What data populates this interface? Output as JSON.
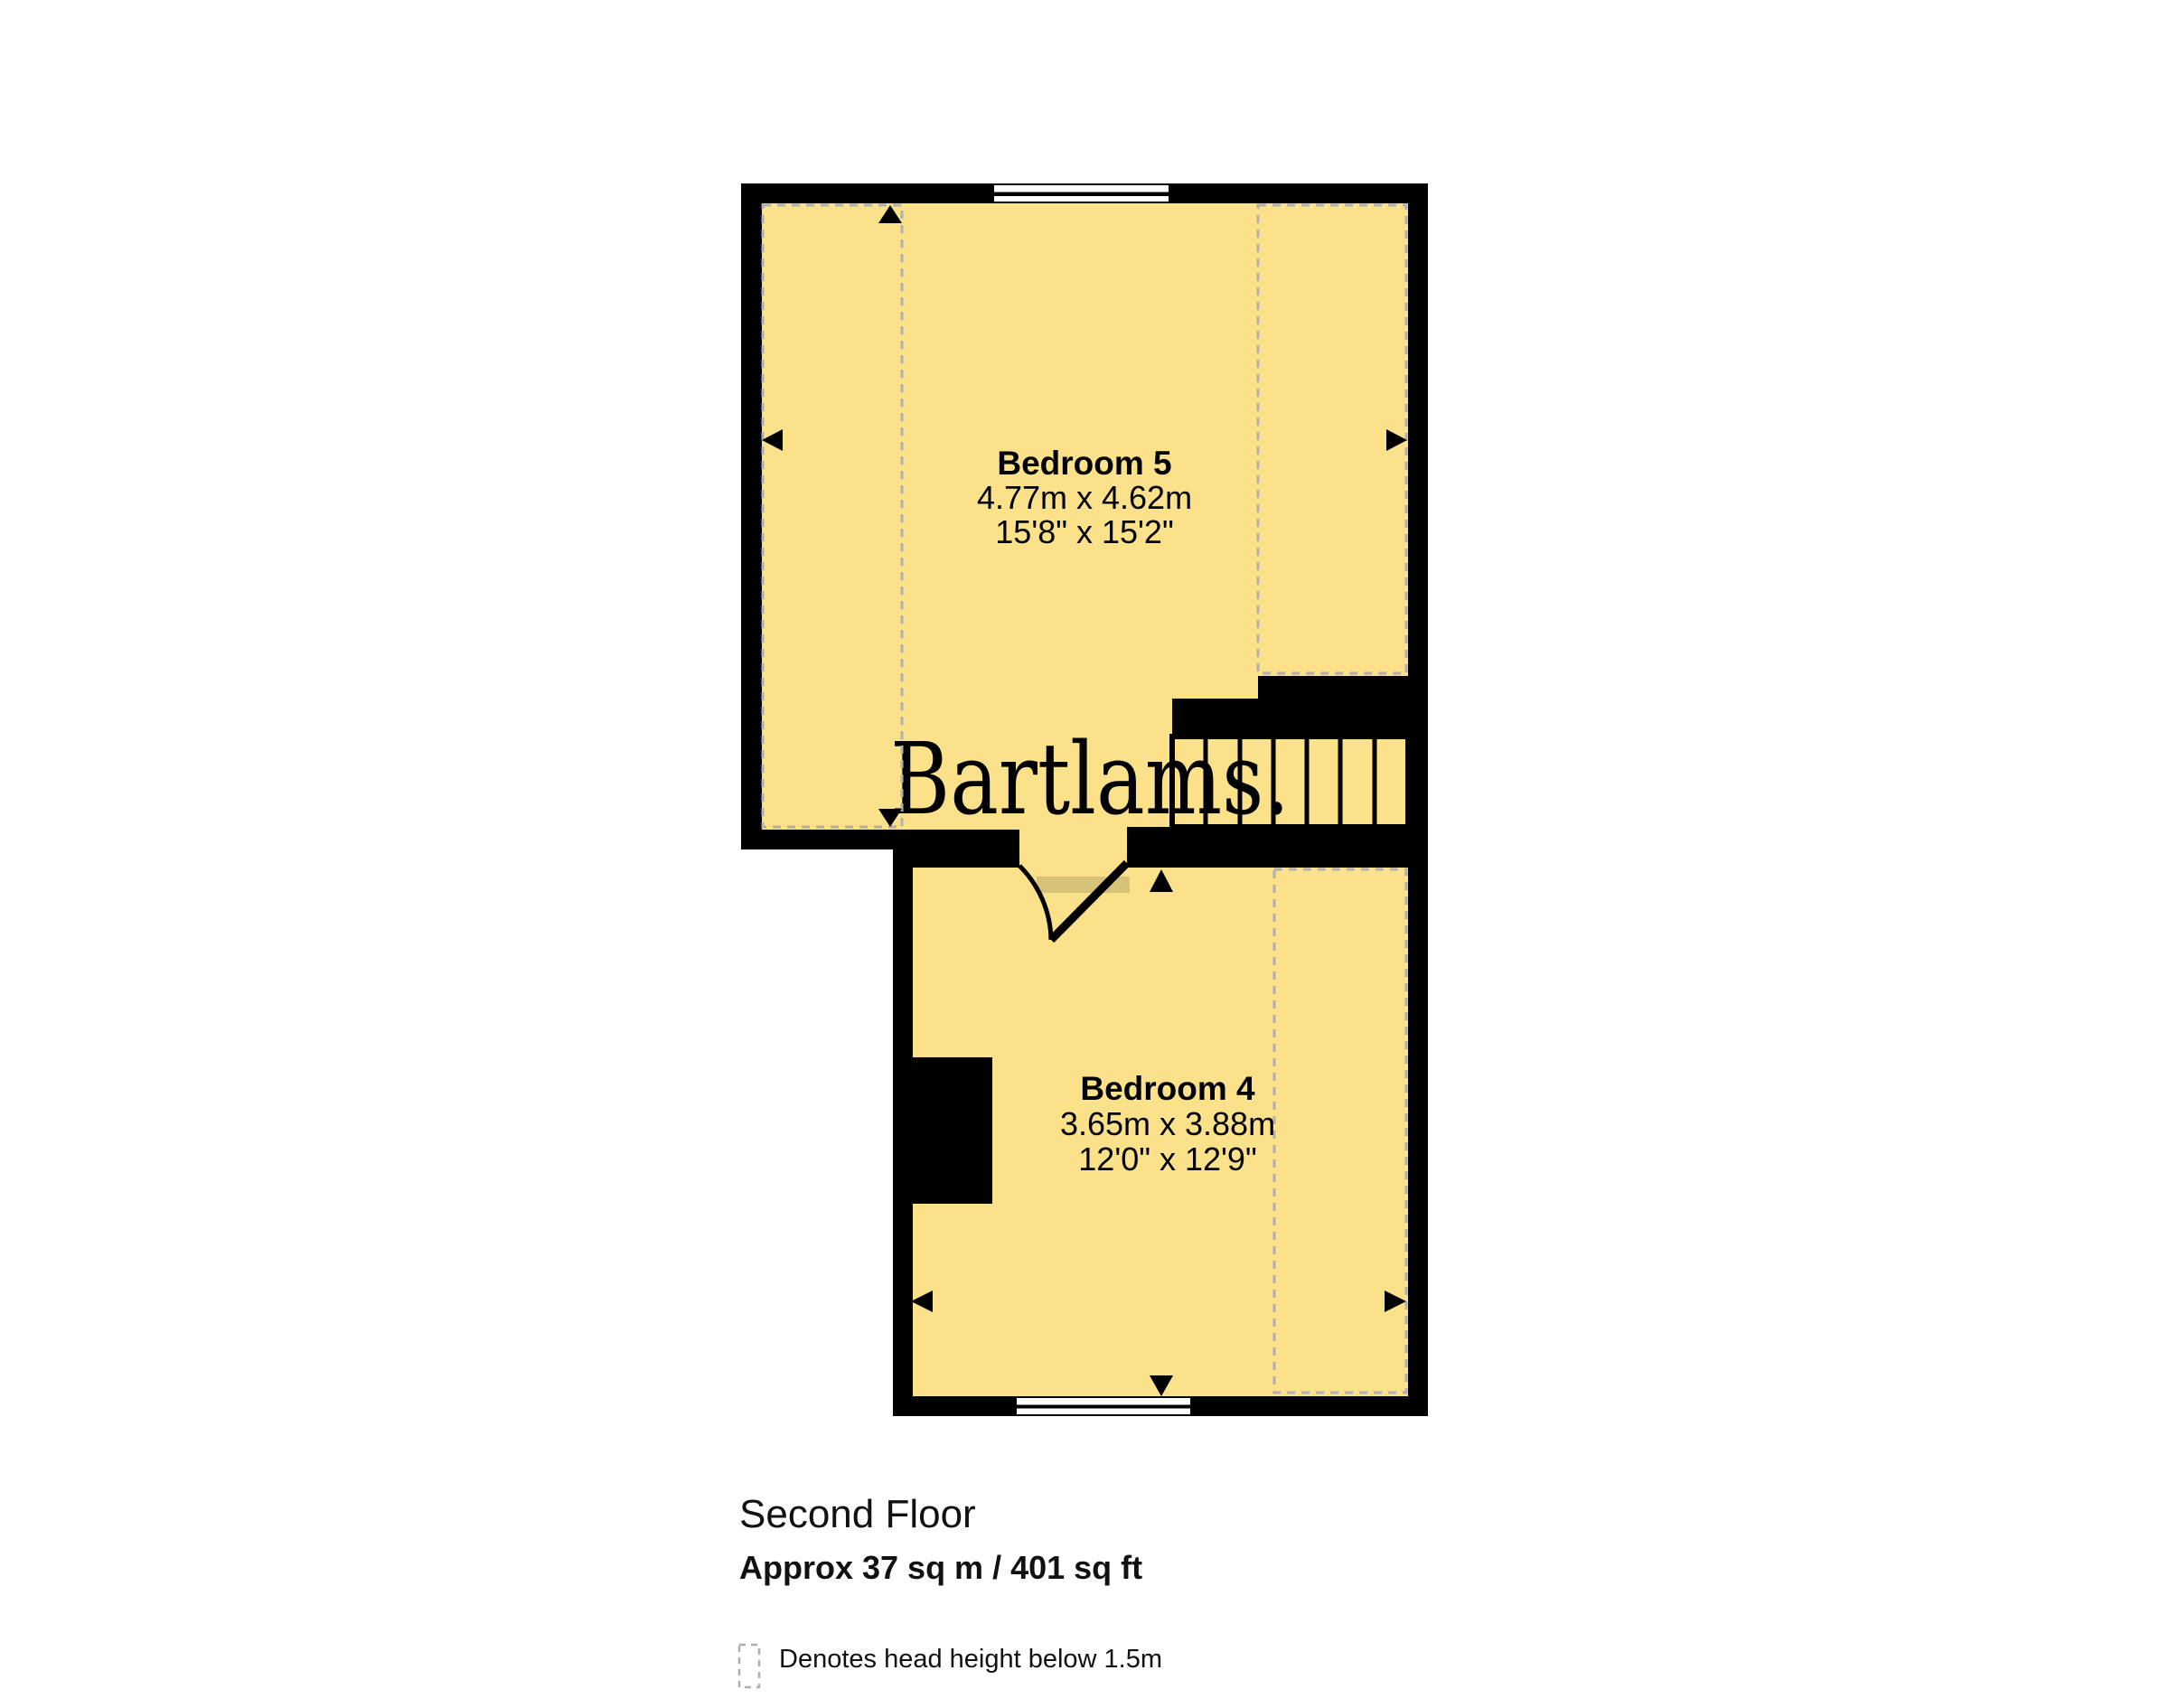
{
  "floorplan": {
    "watermark": "Bartlams.",
    "title": "Second Floor",
    "area": "Approx 37 sq m / 401 sq ft",
    "legend_label": "Denotes head height below 1.5m",
    "rooms": [
      {
        "name": "Bedroom 5",
        "size_metric": "4.77m x 4.62m",
        "size_imperial": "15'8\" x 15'2\""
      },
      {
        "name": "Bedroom 4",
        "size_metric": "3.65m x 3.88m",
        "size_imperial": "12'0\" x 12'9\""
      }
    ],
    "colors": {
      "room_fill": "#fbe189",
      "wall": "#000000",
      "dashed_line": "#b0b0b0",
      "watermark": "#e9b47c",
      "door_threshold": "#d7c377"
    }
  }
}
